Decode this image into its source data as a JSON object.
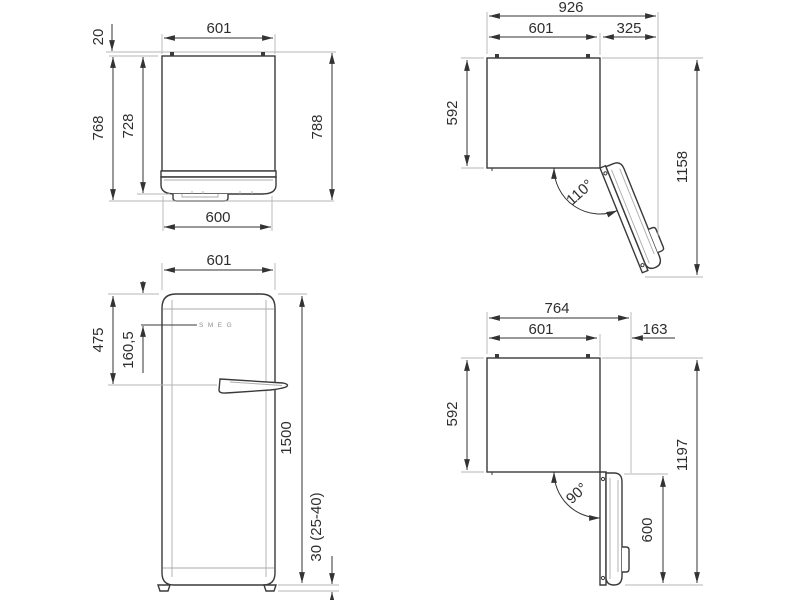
{
  "drawing": {
    "background": "#ffffff",
    "line_color": "#3a3a3a",
    "ext_line_color": "#b4b4b4",
    "views": {
      "top_plan_closed": {
        "width_top": "601",
        "wall_gap": "20",
        "depth_left": "768",
        "depth_door": "728",
        "depth_right": "788",
        "width_door": "600"
      },
      "top_plan_door_110": {
        "total_width": "926",
        "body_width": "601",
        "door_swing": "325",
        "body_depth": "592",
        "total_depth": "1158",
        "angle": "110°"
      },
      "front": {
        "width": "601",
        "handle_from_top": "475",
        "logo_from_top": "160,5",
        "height": "1500",
        "feet_height": "30 (25-40)",
        "logo": "SMEG"
      },
      "top_plan_door_90": {
        "total_width": "764",
        "body_width": "601",
        "door_swing": "163",
        "body_depth": "592",
        "total_depth": "1197",
        "angle": "90°",
        "door_length": "600"
      }
    }
  }
}
